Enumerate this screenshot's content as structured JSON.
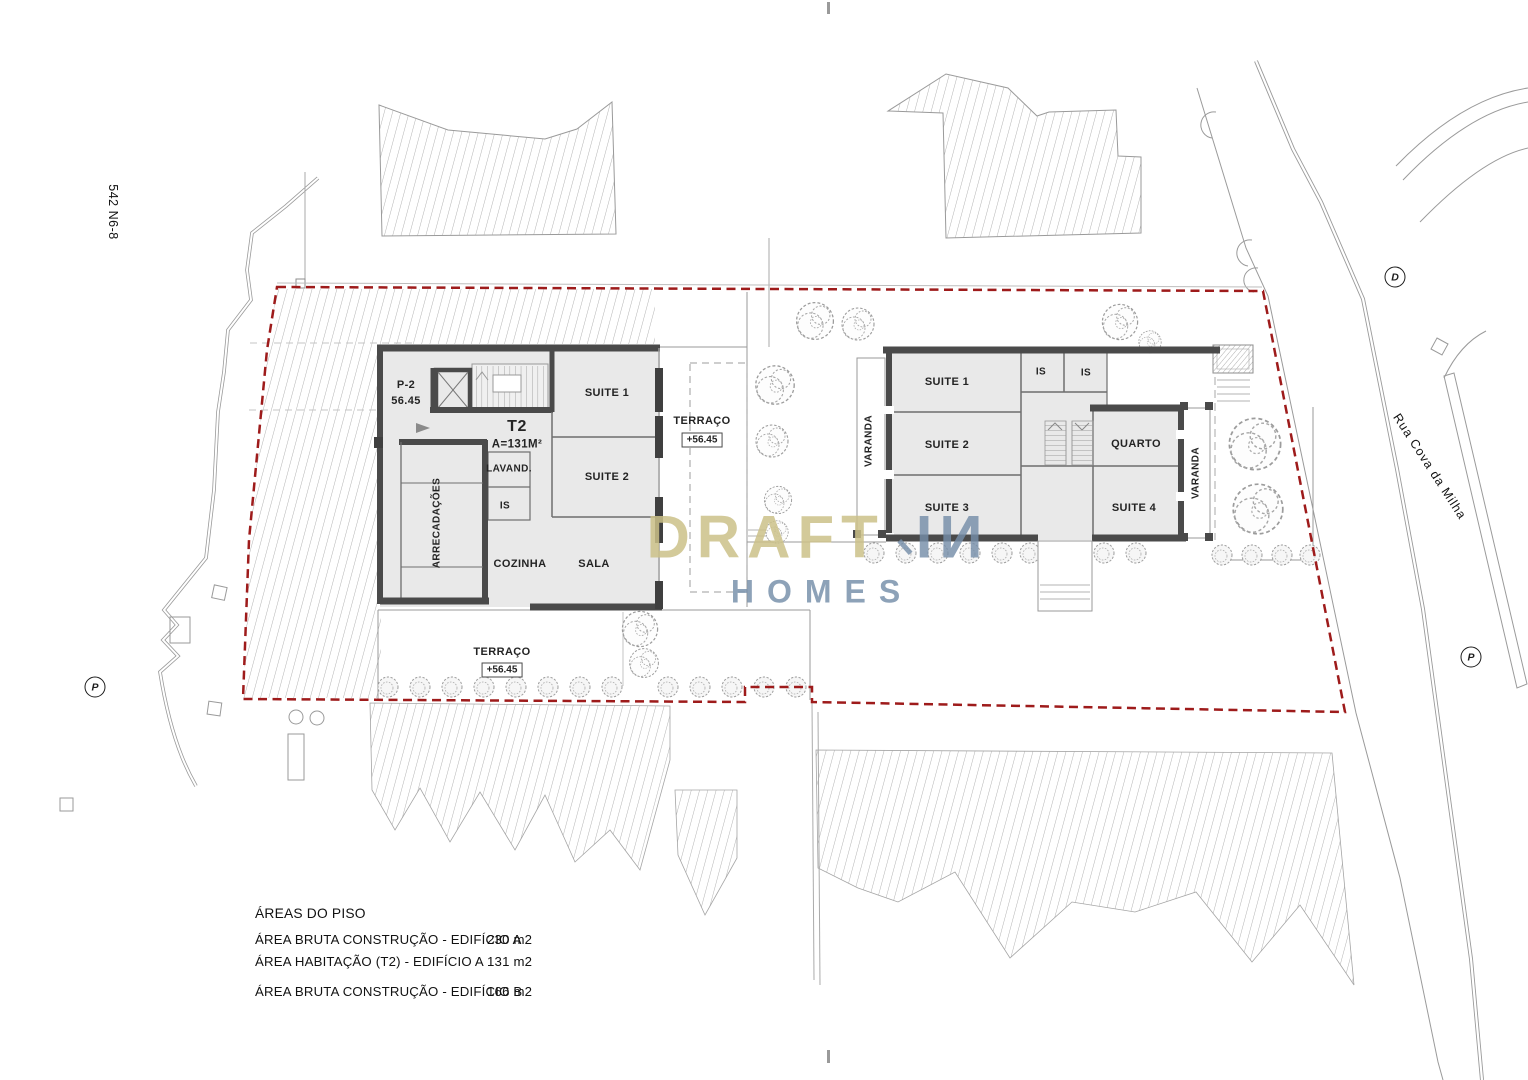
{
  "site": {
    "plot_ref": "542 N6-8",
    "street_name": "Rua Cova da Milha",
    "marker_d": "D",
    "marker_p_west": "P",
    "marker_p_east": "P"
  },
  "building_a": {
    "stair_core_ref": "P-2",
    "stair_core_level": "56.45",
    "unit_type": "T2",
    "unit_area": "A=131M²",
    "suite1": "SUITE 1",
    "suite2": "SUITE 2",
    "lavand": "LAVAND.",
    "is": "IS",
    "arrecadacoes": "ARRECADAÇÕES",
    "cozinha": "COZINHA",
    "sala": "SALA",
    "terrace_east_label": "TERRAÇO",
    "terrace_east_level": "+56.45",
    "terrace_south_label": "TERRAÇO",
    "terrace_south_level": "+56.45"
  },
  "building_b": {
    "suite1": "SUITE 1",
    "is1": "IS",
    "is2": "IS",
    "suite2": "SUITE 2",
    "suite3": "SUITE 3",
    "quarto": "QUARTO",
    "suite4": "SUITE 4",
    "varanda_west": "VARANDA",
    "varanda_east": "VARANDA"
  },
  "watermark": {
    "word1": "DRAFT",
    "word2": "IИ",
    "word3": "HOMES"
  },
  "areas_table": {
    "title": "ÁREAS DO PISO",
    "rows": [
      {
        "label": "ÁREA BRUTA CONSTRUÇÃO - EDIFÍCIO A",
        "value": "230 m2"
      },
      {
        "label": "ÁREA HABITAÇÃO (T2) - EDIFÍCIO A",
        "value": "131 m2"
      },
      {
        "label": "ÁREA BRUTA CONSTRUÇÃO - EDIFÍCIO B",
        "value": "166 m2"
      }
    ]
  },
  "colors": {
    "boundary_red": "#9e1b1b",
    "wall_dark": "#4a4a4a",
    "room_fill": "#e9e9e9",
    "watermark_gold": "#cbc188",
    "watermark_blue": "#7592ab"
  }
}
